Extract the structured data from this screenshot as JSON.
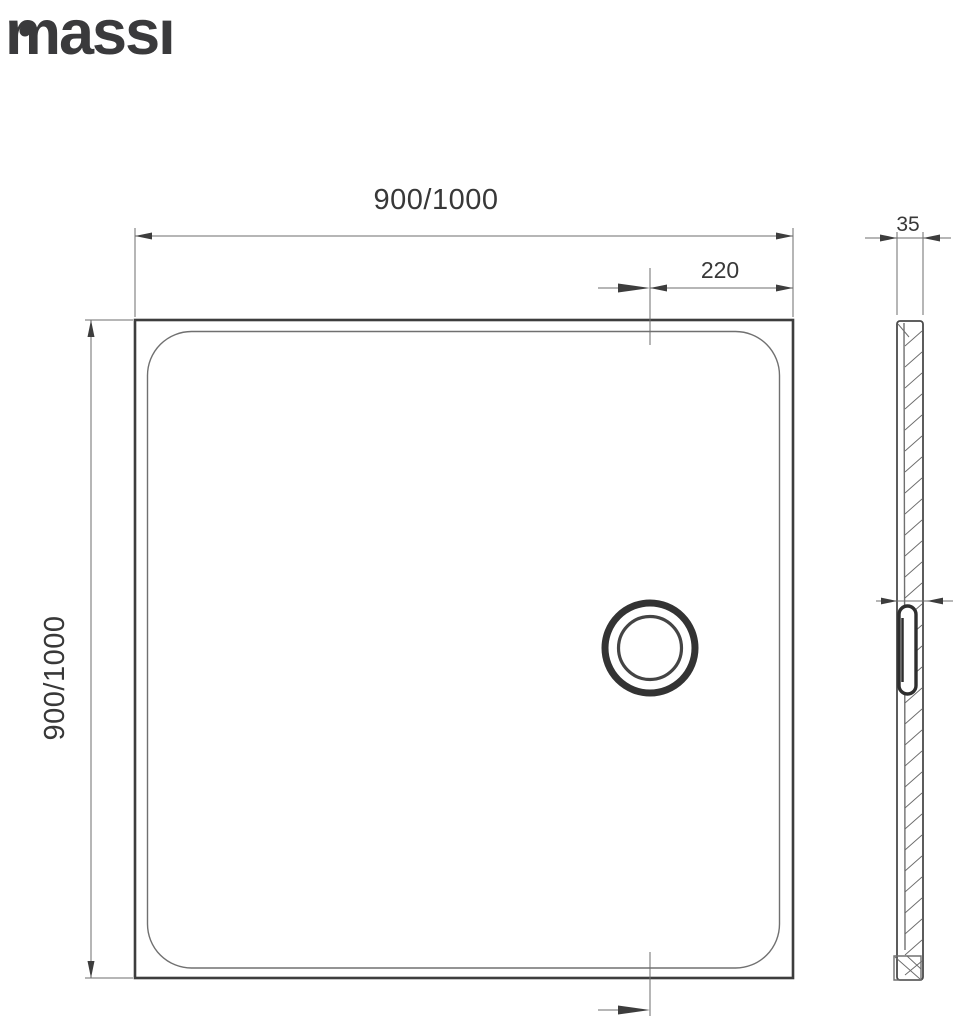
{
  "brand": {
    "name": "massi",
    "display": "massı"
  },
  "drawing": {
    "top_view": {
      "width_label": "900/1000",
      "height_label": "900/1000",
      "drain_offset_label": "220"
    },
    "side_view": {
      "thickness_label": "35"
    },
    "colors": {
      "line_dark": "#3d3d3d",
      "line_thin": "#6e6e6e",
      "text": "#383838",
      "background": "#ffffff"
    }
  }
}
